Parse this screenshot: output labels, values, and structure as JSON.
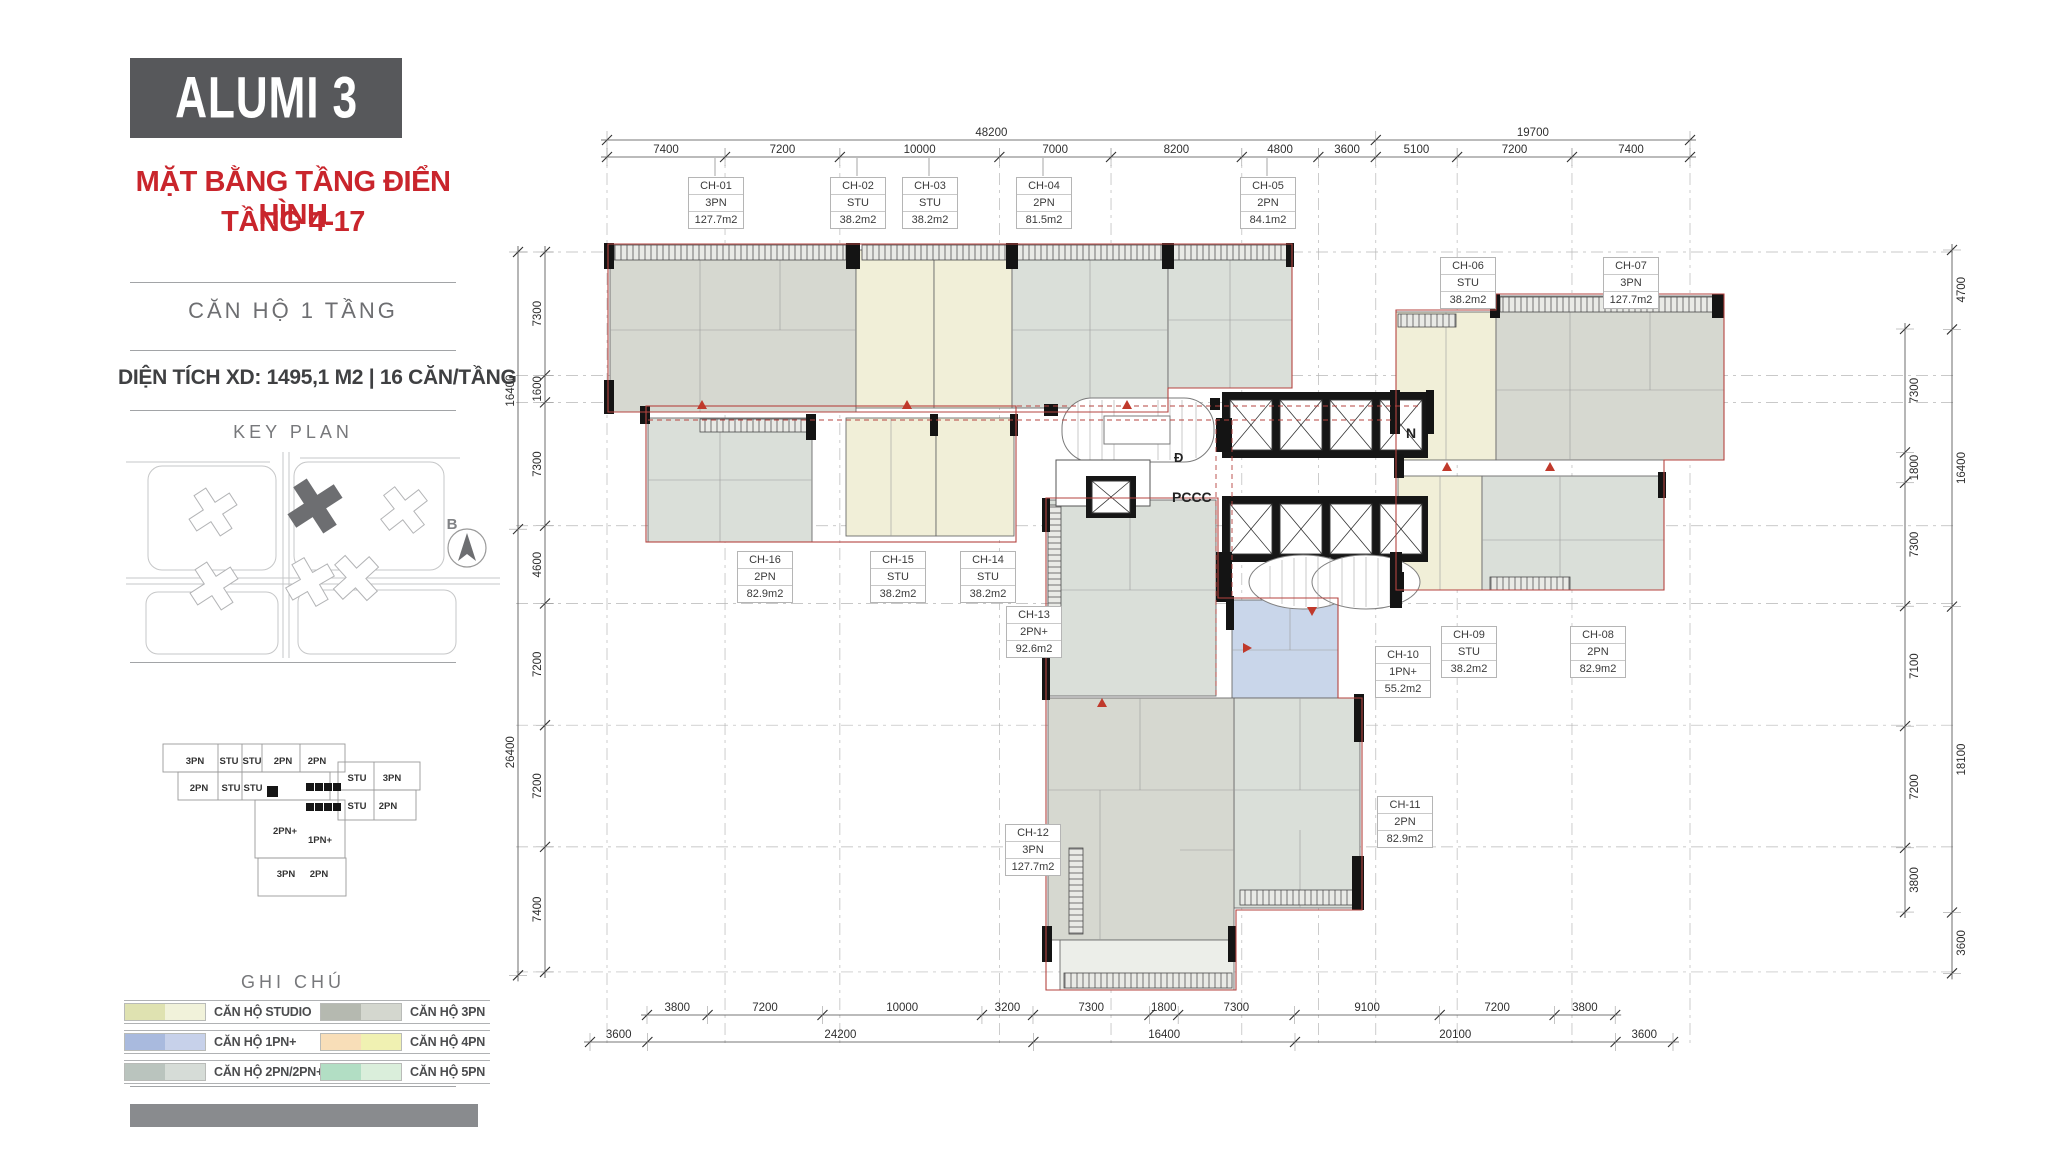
{
  "sidebar": {
    "title": "ALUMI 3",
    "subtitle_line1": "MẶT BẰNG TẦNG ĐIỂN HÌNH",
    "subtitle_line2": "TẦNG 4-17",
    "section1": "CĂN HỘ 1 TẦNG",
    "stats": "DIỆN TÍCH XD: 1495,1 M2  |  16 CĂN/TẦNG",
    "keyplan_title": "KEY PLAN",
    "compass_label": "B",
    "miniplan_labels": [
      "3PN",
      "STU",
      "STU",
      "2PN",
      "2PN",
      "STU",
      "3PN",
      "2PN",
      "STU",
      "STU",
      "STU",
      "2PN",
      "2PN+",
      "1PN+",
      "3PN",
      "2PN"
    ],
    "legend_title": "GHI CHÚ",
    "legend": [
      {
        "label": "CĂN HỘ STUDIO",
        "c1": "#dfe2b1",
        "c2": "#f1f2da"
      },
      {
        "label": "CĂN HỘ 1PN+",
        "c1": "#a9bade",
        "c2": "#c7d1ea"
      },
      {
        "label": "CĂN HỘ 2PN/2PN+",
        "c1": "#bac4be",
        "c2": "#d6dcd7"
      },
      {
        "label": "CĂN HỘ 3PN",
        "c1": "#b5b9b0",
        "c2": "#d4d7cf"
      },
      {
        "label": "CĂN HỘ 4PN",
        "c1": "#f8deb8",
        "c2": "#f0f1b2"
      },
      {
        "label": "CĂN HỘ 5PN",
        "c1": "#b2dec4",
        "c2": "#daeedb"
      }
    ]
  },
  "plan": {
    "units": [
      {
        "id": "CH-01",
        "type": "3PN",
        "area": "127.7m2"
      },
      {
        "id": "CH-02",
        "type": "STU",
        "area": "38.2m2"
      },
      {
        "id": "CH-03",
        "type": "STU",
        "area": "38.2m2"
      },
      {
        "id": "CH-04",
        "type": "2PN",
        "area": "81.5m2"
      },
      {
        "id": "CH-05",
        "type": "2PN",
        "area": "84.1m2"
      },
      {
        "id": "CH-06",
        "type": "STU",
        "area": "38.2m2"
      },
      {
        "id": "CH-07",
        "type": "3PN",
        "area": "127.7m2"
      },
      {
        "id": "CH-08",
        "type": "2PN",
        "area": "82.9m2"
      },
      {
        "id": "CH-09",
        "type": "STU",
        "area": "38.2m2"
      },
      {
        "id": "CH-10",
        "type": "1PN+",
        "area": "55.2m2"
      },
      {
        "id": "CH-11",
        "type": "2PN",
        "area": "82.9m2"
      },
      {
        "id": "CH-12",
        "type": "3PN",
        "area": "127.7m2"
      },
      {
        "id": "CH-13",
        "type": "2PN+",
        "area": "92.6m2"
      },
      {
        "id": "CH-14",
        "type": "STU",
        "area": "38.2m2"
      },
      {
        "id": "CH-15",
        "type": "STU",
        "area": "38.2m2"
      },
      {
        "id": "CH-16",
        "type": "2PN",
        "area": "82.9m2"
      }
    ],
    "core_labels": {
      "pccc": "PCCC",
      "n": "N",
      "d": "Đ"
    },
    "dimensions": {
      "top_overall": [
        "48200",
        "19700"
      ],
      "top": [
        "7400",
        "7200",
        "10000",
        "7000",
        "8200",
        "4800",
        "3600",
        "5100",
        "7200",
        "7400"
      ],
      "left_overall": [
        "16400",
        "26400"
      ],
      "left": [
        "7300",
        "1600",
        "7300",
        "4600",
        "7200",
        "7200",
        "7400"
      ],
      "right_outer": [
        "4700",
        "16400",
        "18100",
        "3600"
      ],
      "right": [
        "7300",
        "1800",
        "7300",
        "7100",
        "7200",
        "3800"
      ],
      "bottom": [
        "3800",
        "7200",
        "10000",
        "3200",
        "7300",
        "1800",
        "7300",
        "9100",
        "7200",
        "3800"
      ],
      "bottom_overall": [
        "3600",
        "24200",
        "16400",
        "20100",
        "3600"
      ]
    }
  }
}
